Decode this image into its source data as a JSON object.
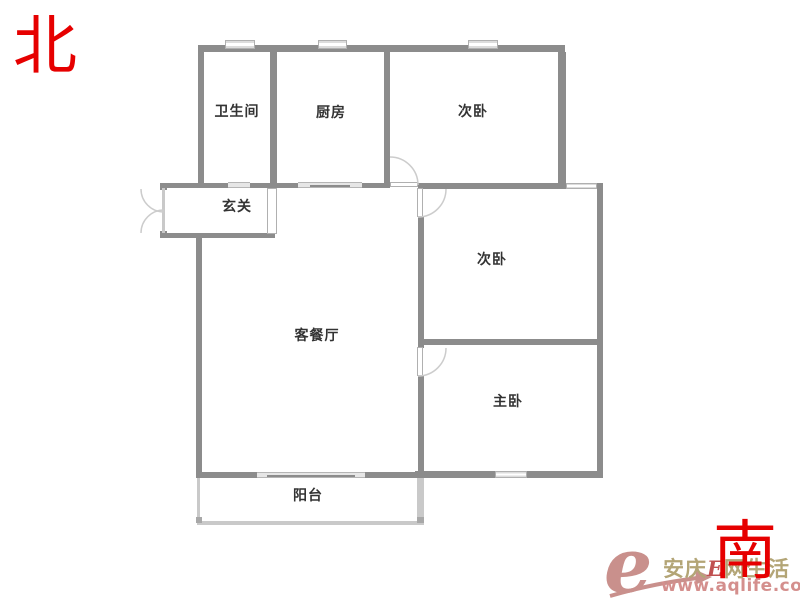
{
  "compass": {
    "north_label": "北",
    "south_label": "南"
  },
  "rooms": {
    "bathroom": "卫生间",
    "kitchen": "厨房",
    "bedroom_north": "次卧",
    "entry": "玄关",
    "bedroom_east": "次卧",
    "living": "客餐厅",
    "master": "主卧",
    "balcony": "阳台"
  },
  "watermark": {
    "logo_letter": "e",
    "brand_prefix": "安庆",
    "brand_e": "E",
    "brand_suffix": "网生活",
    "url": "www.aqlife.com"
  },
  "colors": {
    "wall": "#8c8c8c",
    "wall_light": "#c9c9c9",
    "wall_medium": "#a8a8a8",
    "window_fill": "#dcdcdc",
    "panel_border": "#b0b0b0",
    "arc": "#cccccc",
    "label": "#333333",
    "compass_red": "#e60000",
    "logo_rose": "#c9908c",
    "brand_tan": "#b3a576",
    "url_pink": "#d48f8d",
    "background": "#ffffff"
  }
}
